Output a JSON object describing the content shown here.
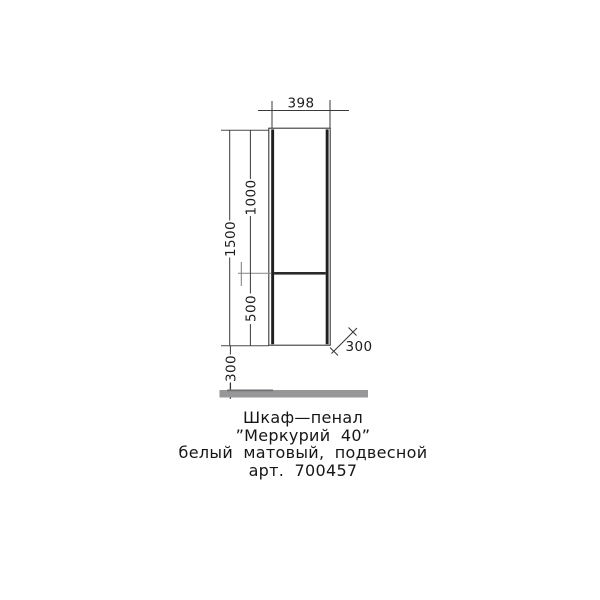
{
  "drawing": {
    "dimensions": {
      "width_top": "398",
      "height_total": "1500",
      "height_upper": "1000",
      "height_lower": "500",
      "floor_gap": "300",
      "depth": "300"
    },
    "caption": {
      "line1": "Шкаф—пенал",
      "line2": "”Меркурий 40”",
      "line3": "белый матовый, подвесной",
      "line4": "арт. 700457"
    },
    "colors": {
      "line": "#333333",
      "wall": "#1f1f21",
      "extension_gray": "#929295",
      "floor": "#97979a",
      "text": "#1c1c1c"
    }
  }
}
